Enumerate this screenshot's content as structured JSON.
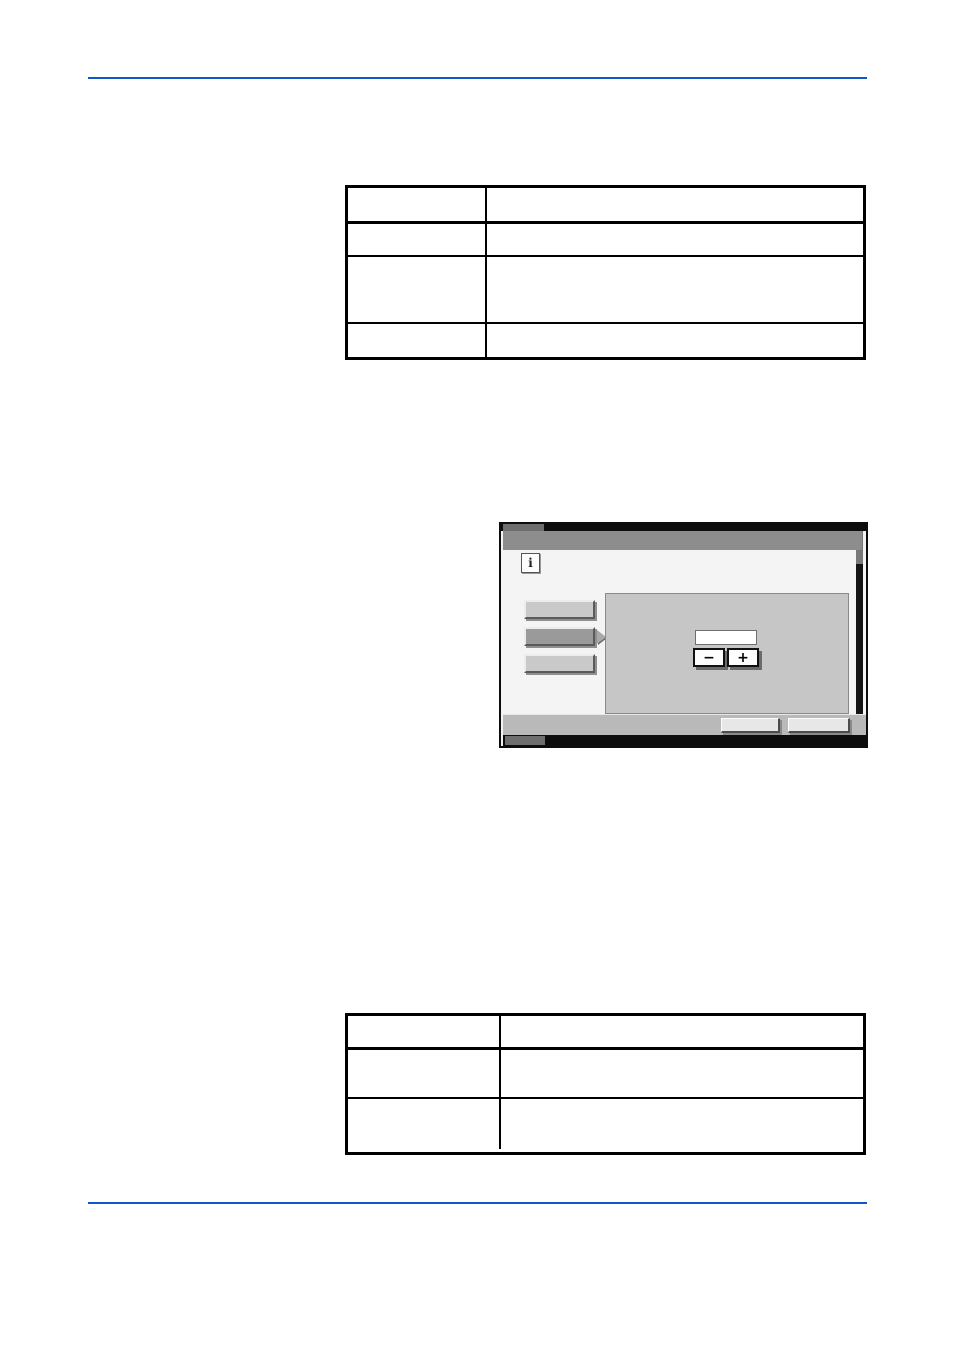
{
  "page": {
    "background": "#ffffff",
    "rule_color": "#1155cc"
  },
  "table_top": {
    "header": {
      "col1": "",
      "col2": ""
    },
    "rows": [
      {
        "col1": "",
        "col2": ""
      },
      {
        "col1": "",
        "col2": ""
      },
      {
        "col1": "",
        "col2": ""
      }
    ]
  },
  "table_bottom": {
    "header": {
      "col1": "",
      "col2": ""
    },
    "rows": [
      {
        "col1": "",
        "col2": ""
      },
      {
        "col1": "",
        "col2": ""
      }
    ]
  },
  "touch_panel": {
    "title": "",
    "info_icon_glyph": "i",
    "side_buttons": [
      {
        "label": "",
        "selected": false
      },
      {
        "label": "",
        "selected": true
      },
      {
        "label": "",
        "selected": false
      }
    ],
    "value_field": "",
    "minus_glyph": "−",
    "plus_glyph": "+",
    "bottom_buttons": [
      {
        "label": ""
      },
      {
        "label": ""
      }
    ],
    "colors": {
      "title_bar": "#8d8d8d",
      "content_bg": "#f4f4f4",
      "main_panel": "#c6c6c6",
      "side_button": "#c9c9c9",
      "side_button_selected": "#9a9a9a",
      "bottom_bar": "#b9b9b9",
      "bezel_black": "#0d0d0d"
    }
  }
}
